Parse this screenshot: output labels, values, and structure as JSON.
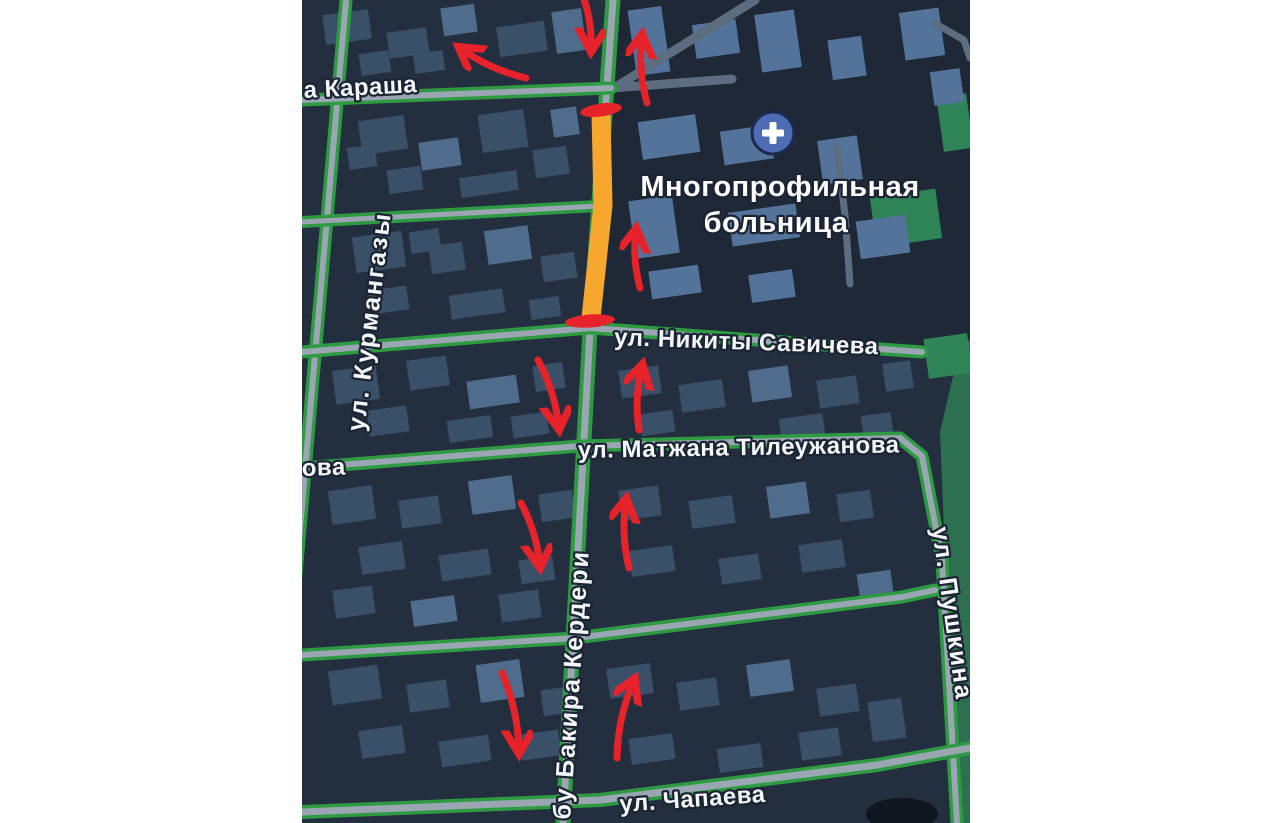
{
  "page": {
    "background": "#ffffff",
    "margin_color": "#ffffff"
  },
  "map": {
    "offset_x": 302,
    "width": 668,
    "height": 823,
    "colors": {
      "base": "#232f3f",
      "district_dark": "#1f2836",
      "park": "#2d7050",
      "park_bright": "#2e8457",
      "road_edge": "#2e9b43",
      "road_core": "#9aa7b3",
      "road_minor": "#5c6d80",
      "building_dim": "#3a4f68",
      "building_light": "#4f6c8c",
      "building_hospital": "#54739b",
      "closure_orange": "#f7a72e",
      "annotation_red": "#e6222a",
      "label_fill": "#f4f7fa",
      "label_outline": "#1c2433",
      "hospital_icon_bg": "#4e6cb3",
      "hospital_icon_ring": "#1e2a4d",
      "hospital_icon_cross": "#ffffff",
      "pond_dark": "#10161f"
    },
    "zones": [
      {
        "name": "hospital-district",
        "points": "311,0 668,0 668,352 292,328",
        "tone": "district_dark"
      }
    ],
    "parks": {
      "main_polygon": "638,432 652,372 668,338 668,823 654,823",
      "patches": [
        [
          638,
          95,
          30,
          55
        ],
        [
          571,
          193,
          66,
          50
        ],
        [
          624,
          336,
          44,
          40
        ]
      ],
      "pond": {
        "cx": 600,
        "cy": 814,
        "rx": 36,
        "ry": 16
      }
    },
    "streets": [
      {
        "name": "kurmangazy",
        "pts": [
          [
            44,
            0
          ],
          [
            -10,
            620
          ]
        ],
        "w": 13,
        "cw": 6
      },
      {
        "name": "bakira-kerderi",
        "pts": [
          [
            311,
            0
          ],
          [
            288,
            330
          ],
          [
            261,
            823
          ]
        ],
        "w": 15,
        "cw": 7
      },
      {
        "name": "karasha",
        "pts": [
          [
            0,
            100
          ],
          [
            309,
            88
          ]
        ],
        "w": 13,
        "cw": 6
      },
      {
        "name": "cross-street",
        "pts": [
          [
            0,
            222
          ],
          [
            296,
            206
          ]
        ],
        "w": 12,
        "cw": 5
      },
      {
        "name": "nikity-savicheva",
        "pts": [
          [
            0,
            352
          ],
          [
            288,
            328
          ],
          [
            620,
            352
          ]
        ],
        "w": 13,
        "cw": 6
      },
      {
        "name": "tileuzhanova-pushkina",
        "pts": [
          [
            0,
            468
          ],
          [
            278,
            446
          ],
          [
            598,
            438
          ],
          [
            620,
            456
          ],
          [
            640,
            560
          ],
          [
            655,
            823
          ]
        ],
        "w": 13,
        "cw": 6
      },
      {
        "name": "mid-south-street",
        "pts": [
          [
            0,
            655
          ],
          [
            273,
            638
          ],
          [
            600,
            597
          ],
          [
            633,
            590
          ]
        ],
        "w": 13,
        "cw": 6
      },
      {
        "name": "chapaeva",
        "pts": [
          [
            0,
            812
          ],
          [
            298,
            800
          ],
          [
            575,
            765
          ],
          [
            668,
            748
          ]
        ],
        "w": 14,
        "cw": 7
      }
    ],
    "minor_roads": [
      {
        "name": "hospital-west-road",
        "pts": [
          [
            309,
            90
          ],
          [
            453,
            0
          ]
        ],
        "w": 9
      },
      {
        "name": "karasha-east",
        "pts": [
          [
            309,
            88
          ],
          [
            430,
            79
          ]
        ],
        "w": 9
      },
      {
        "name": "hospital-driveway",
        "pts": [
          [
            535,
            148
          ],
          [
            543,
            215
          ],
          [
            548,
            284
          ]
        ],
        "w": 7
      },
      {
        "name": "corner-road",
        "pts": [
          [
            634,
            24
          ],
          [
            662,
            40
          ],
          [
            668,
            58
          ]
        ],
        "w": 7
      }
    ],
    "closure": {
      "band": {
        "pts": [
          [
            299,
            113
          ],
          [
            301,
            205
          ],
          [
            289,
            318
          ]
        ],
        "width": 19
      },
      "caps": [
        {
          "cx": 299,
          "cy": 110,
          "rx": 21,
          "ry": 6.5,
          "rot": -8
        },
        {
          "cx": 288,
          "cy": 321,
          "rx": 25,
          "ry": 6.5,
          "rot": -4
        }
      ]
    },
    "buildings": {
      "rot": -8,
      "items": [
        [
          22,
          12,
          46,
          30,
          0
        ],
        [
          86,
          30,
          40,
          26,
          0
        ],
        [
          140,
          6,
          34,
          28,
          1
        ],
        [
          196,
          24,
          48,
          30,
          0
        ],
        [
          112,
          52,
          30,
          20,
          0
        ],
        [
          252,
          10,
          30,
          42,
          1
        ],
        [
          58,
          52,
          30,
          22,
          0
        ],
        [
          58,
          118,
          46,
          34,
          0
        ],
        [
          118,
          140,
          40,
          28,
          1
        ],
        [
          178,
          112,
          46,
          38,
          0
        ],
        [
          232,
          148,
          34,
          28,
          0
        ],
        [
          86,
          168,
          34,
          24,
          0
        ],
        [
          158,
          174,
          58,
          20,
          0
        ],
        [
          250,
          108,
          26,
          28,
          1
        ],
        [
          46,
          146,
          28,
          22,
          0
        ],
        [
          52,
          234,
          50,
          36,
          0
        ],
        [
          128,
          244,
          34,
          28,
          0
        ],
        [
          184,
          228,
          44,
          34,
          1
        ],
        [
          240,
          254,
          34,
          26,
          0
        ],
        [
          68,
          288,
          38,
          24,
          0
        ],
        [
          148,
          292,
          54,
          24,
          0
        ],
        [
          228,
          298,
          30,
          20,
          0
        ],
        [
          108,
          230,
          30,
          22,
          0
        ],
        [
          32,
          368,
          44,
          34,
          0
        ],
        [
          106,
          358,
          40,
          30,
          0
        ],
        [
          166,
          378,
          50,
          28,
          1
        ],
        [
          232,
          364,
          30,
          26,
          0
        ],
        [
          66,
          408,
          40,
          26,
          0
        ],
        [
          146,
          418,
          44,
          22,
          0
        ],
        [
          210,
          414,
          36,
          22,
          0
        ],
        [
          318,
          368,
          40,
          28,
          0
        ],
        [
          378,
          382,
          44,
          28,
          0
        ],
        [
          448,
          368,
          40,
          32,
          1
        ],
        [
          516,
          378,
          40,
          28,
          0
        ],
        [
          582,
          362,
          28,
          28,
          0
        ],
        [
          338,
          412,
          34,
          22,
          0
        ],
        [
          478,
          416,
          44,
          22,
          0
        ],
        [
          560,
          414,
          30,
          20,
          0
        ],
        [
          28,
          488,
          44,
          34,
          0
        ],
        [
          98,
          498,
          40,
          28,
          0
        ],
        [
          168,
          478,
          44,
          34,
          1
        ],
        [
          238,
          492,
          34,
          28,
          0
        ],
        [
          58,
          544,
          44,
          28,
          0
        ],
        [
          138,
          552,
          50,
          26,
          0
        ],
        [
          218,
          558,
          34,
          24,
          0
        ],
        [
          32,
          588,
          40,
          28,
          0
        ],
        [
          110,
          598,
          44,
          26,
          1
        ],
        [
          198,
          592,
          40,
          28,
          0
        ],
        [
          318,
          488,
          40,
          30,
          0
        ],
        [
          388,
          498,
          44,
          28,
          0
        ],
        [
          466,
          484,
          40,
          32,
          1
        ],
        [
          536,
          492,
          34,
          28,
          0
        ],
        [
          328,
          548,
          44,
          26,
          0
        ],
        [
          418,
          556,
          40,
          26,
          0
        ],
        [
          498,
          542,
          44,
          28,
          0
        ],
        [
          556,
          572,
          34,
          22,
          1
        ],
        [
          28,
          668,
          50,
          34,
          0
        ],
        [
          106,
          682,
          40,
          28,
          0
        ],
        [
          176,
          662,
          44,
          38,
          1
        ],
        [
          240,
          688,
          34,
          26,
          0
        ],
        [
          58,
          728,
          44,
          28,
          0
        ],
        [
          138,
          738,
          50,
          26,
          0
        ],
        [
          218,
          732,
          40,
          26,
          0
        ],
        [
          306,
          666,
          44,
          30,
          0
        ],
        [
          376,
          680,
          40,
          28,
          0
        ],
        [
          446,
          662,
          44,
          32,
          1
        ],
        [
          516,
          686,
          40,
          28,
          0
        ],
        [
          328,
          736,
          44,
          26,
          0
        ],
        [
          416,
          746,
          44,
          24,
          0
        ],
        [
          498,
          730,
          40,
          28,
          0
        ],
        [
          568,
          700,
          34,
          40,
          0
        ],
        [
          330,
          8,
          34,
          66,
          2
        ],
        [
          392,
          22,
          44,
          34,
          2
        ],
        [
          456,
          12,
          40,
          58,
          2
        ],
        [
          528,
          38,
          34,
          40,
          2
        ],
        [
          338,
          118,
          58,
          38,
          2
        ],
        [
          420,
          128,
          50,
          34,
          2
        ],
        [
          330,
          198,
          44,
          58,
          2
        ],
        [
          428,
          208,
          68,
          34,
          2
        ],
        [
          518,
          138,
          40,
          44,
          2
        ],
        [
          556,
          218,
          50,
          38,
          2
        ],
        [
          348,
          268,
          50,
          28,
          2
        ],
        [
          448,
          272,
          44,
          28,
          2
        ],
        [
          600,
          10,
          40,
          48,
          2
        ],
        [
          630,
          70,
          30,
          34,
          2
        ]
      ]
    },
    "arrows": [
      {
        "name": "arrow-down-top",
        "x1": 281,
        "y1": -4,
        "x2": 289,
        "y2": 50
      },
      {
        "name": "arrow-left-top",
        "x1": 224,
        "y1": 78,
        "x2": 158,
        "y2": 48
      },
      {
        "name": "arrow-up-top-right",
        "x1": 345,
        "y1": 103,
        "x2": 340,
        "y2": 36
      },
      {
        "name": "arrow-up-hospital",
        "x1": 338,
        "y1": 288,
        "x2": 334,
        "y2": 230
      },
      {
        "name": "arrow-down-savicheva",
        "x1": 236,
        "y1": 360,
        "x2": 257,
        "y2": 428
      },
      {
        "name": "arrow-up-savicheva",
        "x1": 337,
        "y1": 430,
        "x2": 340,
        "y2": 366
      },
      {
        "name": "arrow-down-tileuzhanova",
        "x1": 219,
        "y1": 503,
        "x2": 238,
        "y2": 566
      },
      {
        "name": "arrow-up-tileuzhanova",
        "x1": 327,
        "y1": 568,
        "x2": 324,
        "y2": 500
      },
      {
        "name": "arrow-down-bottom",
        "x1": 200,
        "y1": 673,
        "x2": 217,
        "y2": 752
      },
      {
        "name": "arrow-up-bottom",
        "x1": 315,
        "y1": 758,
        "x2": 332,
        "y2": 680
      }
    ],
    "labels": [
      {
        "name": "street-label-karasha",
        "text": "а Караша",
        "x": 2,
        "y": 98,
        "rot": -3,
        "size": 24,
        "spacing": 0.5
      },
      {
        "name": "street-label-kurmangazy",
        "text": "ул. Курмангазы",
        "x": 62,
        "y": 432,
        "rot": -83,
        "size": 25,
        "spacing": 2
      },
      {
        "name": "street-label-kerderi",
        "text": "бу Бакира Кердери",
        "x": 268,
        "y": 820,
        "rot": -86,
        "size": 25,
        "spacing": 2
      },
      {
        "name": "street-label-pushkina",
        "text": "ул. Пушкина",
        "x": 630,
        "y": 528,
        "rot": 82,
        "size": 25,
        "spacing": 2
      },
      {
        "name": "street-label-savicheva",
        "text": "ул. Никиты Савичева",
        "x": 312,
        "y": 345,
        "rot": 2,
        "size": 24,
        "spacing": 0.5
      },
      {
        "name": "street-label-tileuzhanova",
        "text": "ул. Матжана Тилеужанова",
        "x": 276,
        "y": 458,
        "rot": -1,
        "size": 24,
        "spacing": 0.5
      },
      {
        "name": "street-label-ova",
        "text": "ова",
        "x": 0,
        "y": 476,
        "rot": -2,
        "size": 24,
        "spacing": 0.5
      },
      {
        "name": "street-label-chapaeva",
        "text": "ул. Чапаева",
        "x": 318,
        "y": 812,
        "rot": -4,
        "size": 24,
        "spacing": 0.5
      },
      {
        "name": "hospital-label-line1",
        "text": "Многопрофильная",
        "x": 478,
        "y": 196,
        "rot": 0,
        "size": 29,
        "spacing": 0.5,
        "anchor": "middle",
        "fill": "#ffffff"
      },
      {
        "name": "hospital-label-line2",
        "text": "больница",
        "x": 474,
        "y": 232,
        "rot": 0,
        "size": 29,
        "spacing": 0.5,
        "anchor": "middle",
        "fill": "#ffffff"
      }
    ],
    "hospital_icon": {
      "cx": 471,
      "cy": 133,
      "r": 21
    }
  }
}
